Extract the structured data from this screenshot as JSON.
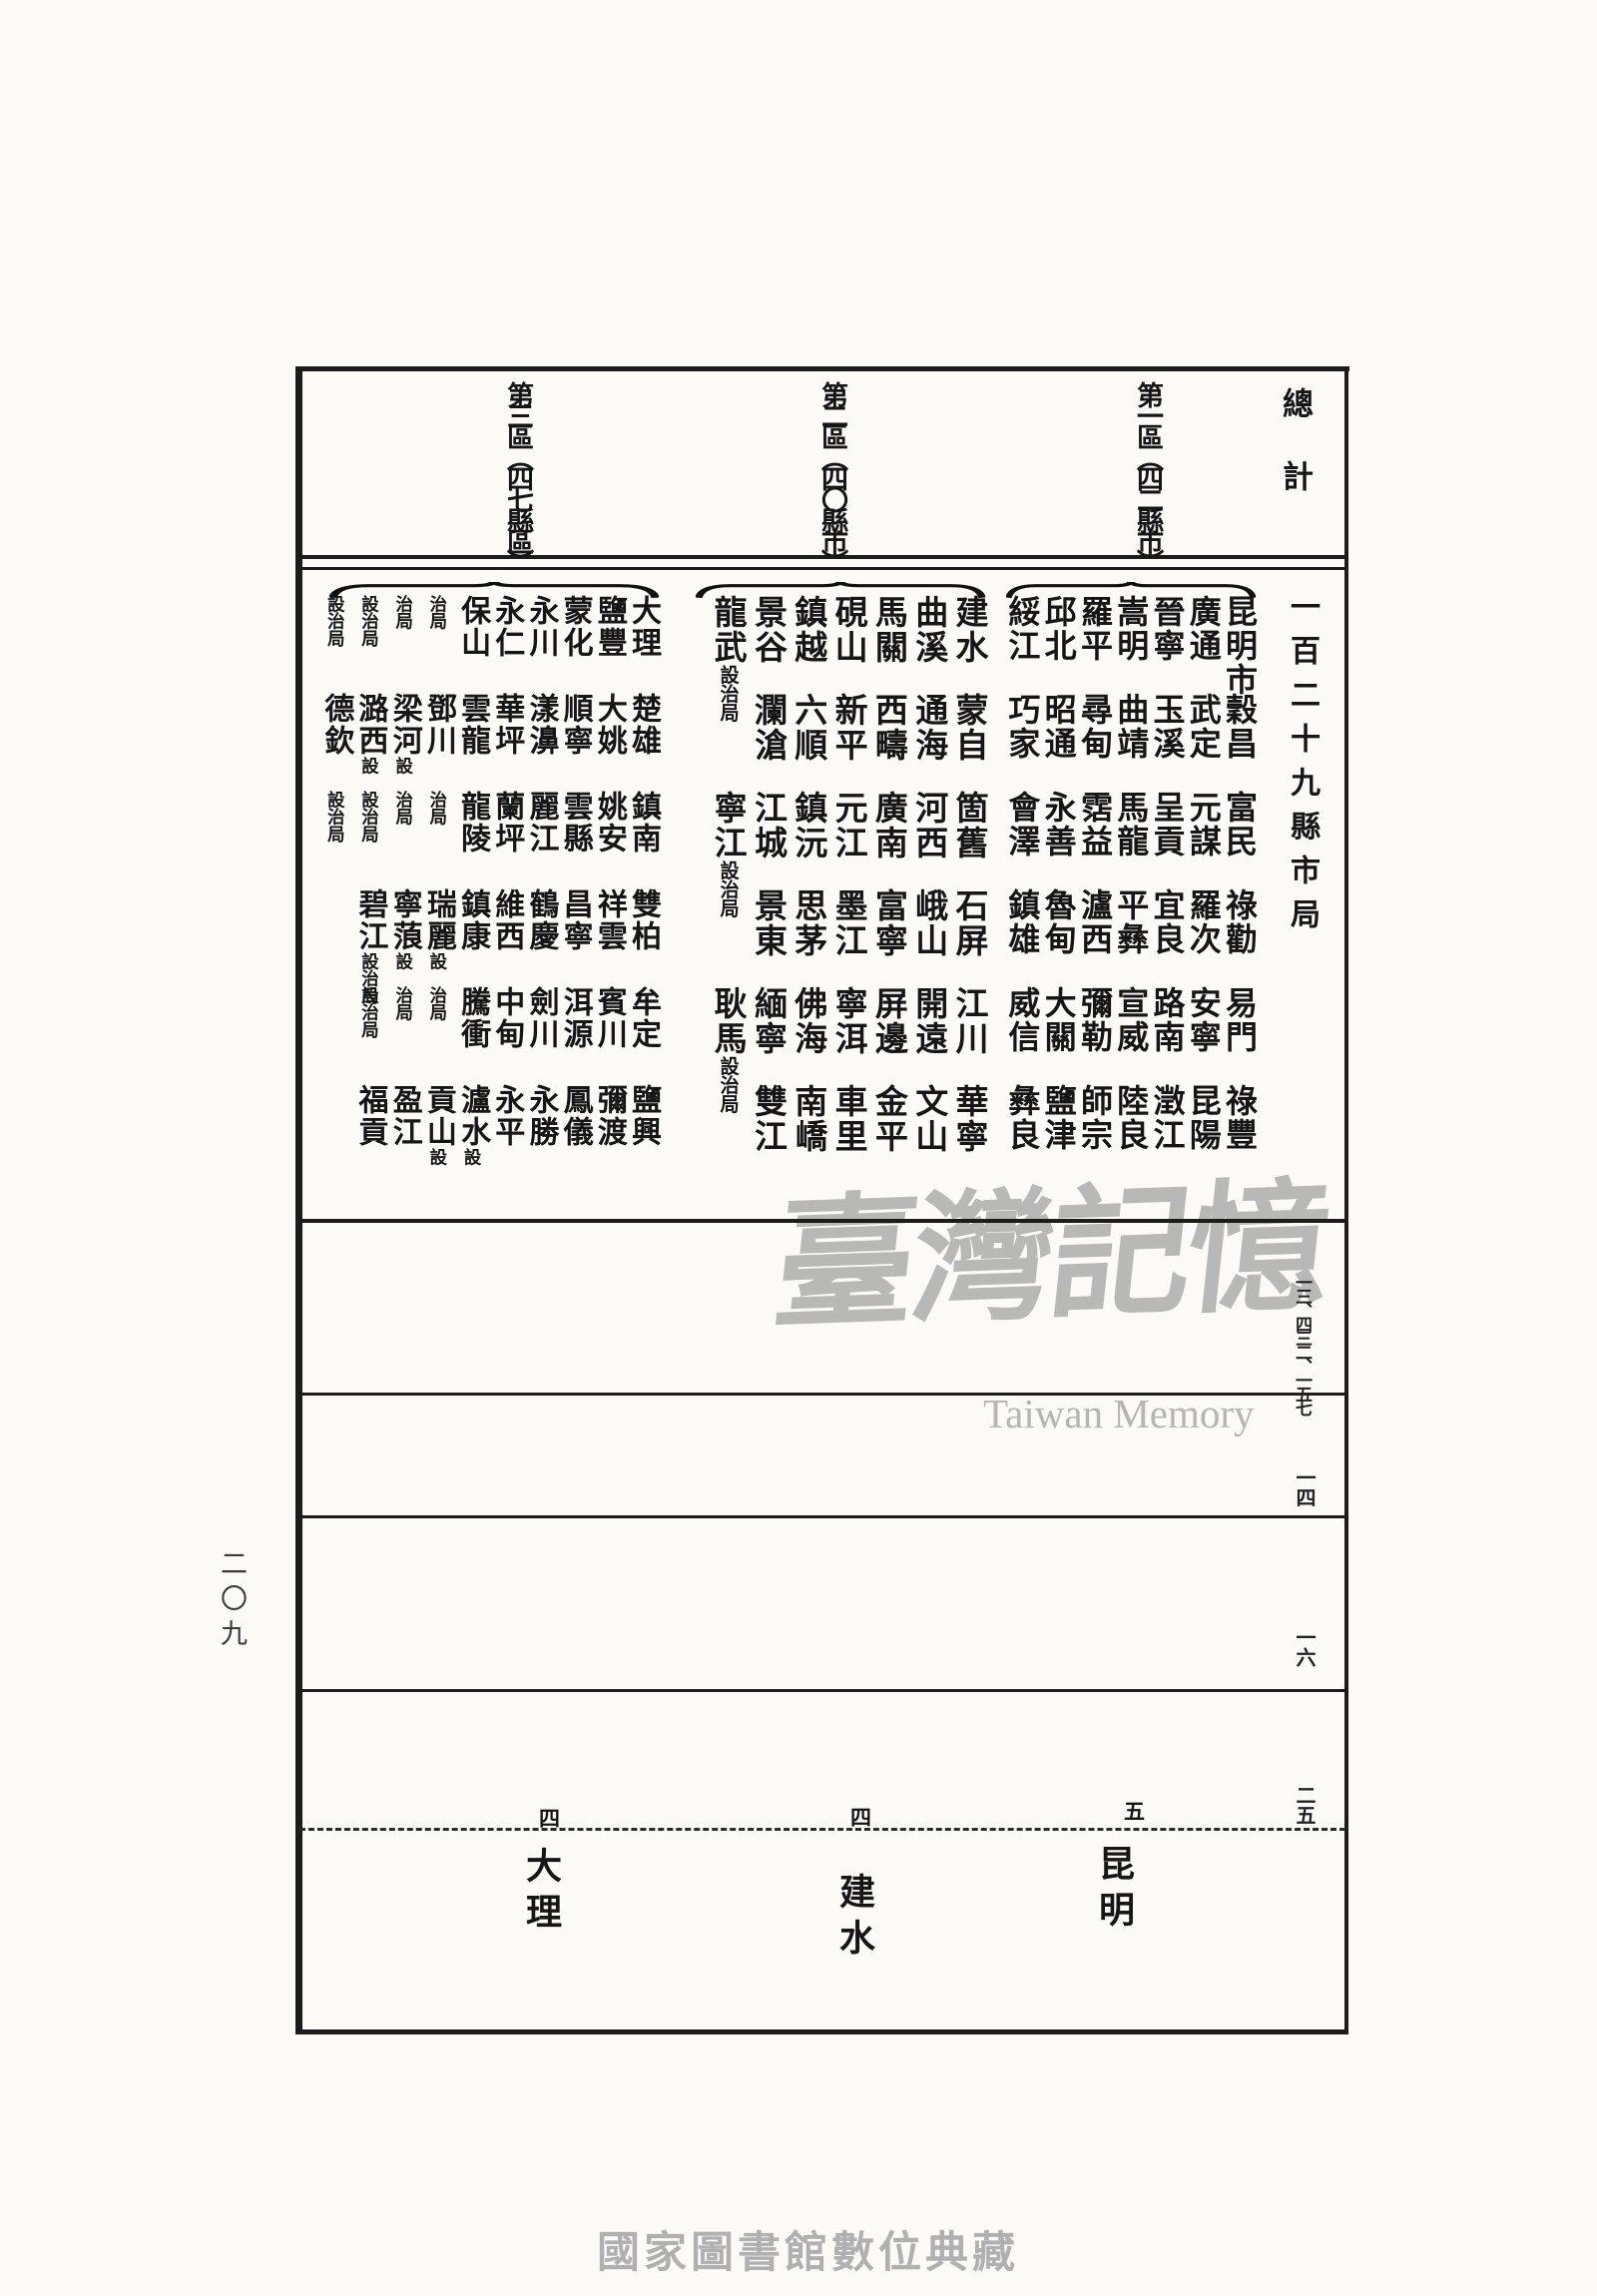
{
  "page": {
    "page_number": "二〇九",
    "caption": "國家圖書館數位典藏"
  },
  "watermark": {
    "cjk": "臺灣記憶",
    "latin": "Taiwan Memory"
  },
  "table": {
    "total_label": "總計",
    "total_value": "一百二十九縣市局",
    "header_regions": [
      "第一區︵四二縣市︶",
      "第二區︵四〇縣市︶",
      "第三區︵四七縣區︶"
    ],
    "margin_numbers": [
      "一三、四三二、一五七",
      "一四",
      "一六",
      "二五"
    ],
    "regions": [
      {
        "label": "第一區",
        "groups": [
          [
            [
              "昆明市",
              ""
            ],
            [
              "廣通",
              ""
            ],
            [
              "晉寧",
              ""
            ],
            [
              "嵩明",
              ""
            ],
            [
              "羅平",
              ""
            ],
            [
              "邱北",
              ""
            ],
            [
              "綏江",
              ""
            ]
          ],
          [
            [
              "穀昌",
              ""
            ],
            [
              "武定",
              ""
            ],
            [
              "玉溪",
              ""
            ],
            [
              "曲靖",
              ""
            ],
            [
              "尋甸",
              ""
            ],
            [
              "昭通",
              ""
            ],
            [
              "巧家",
              ""
            ]
          ],
          [
            [
              "富民",
              ""
            ],
            [
              "元謀",
              ""
            ],
            [
              "呈貢",
              ""
            ],
            [
              "馬龍",
              ""
            ],
            [
              "霑益",
              ""
            ],
            [
              "永善",
              ""
            ],
            [
              "會澤",
              ""
            ]
          ],
          [
            [
              "祿勸",
              ""
            ],
            [
              "羅次",
              ""
            ],
            [
              "宜良",
              ""
            ],
            [
              "平彝",
              ""
            ],
            [
              "瀘西",
              ""
            ],
            [
              "魯甸",
              ""
            ],
            [
              "鎮雄",
              ""
            ]
          ],
          [
            [
              "易門",
              ""
            ],
            [
              "安寧",
              ""
            ],
            [
              "路南",
              ""
            ],
            [
              "宣威",
              ""
            ],
            [
              "彌勒",
              ""
            ],
            [
              "大關",
              ""
            ],
            [
              "威信",
              ""
            ]
          ],
          [
            [
              "祿豐",
              ""
            ],
            [
              "昆陽",
              ""
            ],
            [
              "澂江",
              ""
            ],
            [
              "陸良",
              ""
            ],
            [
              "師宗",
              ""
            ],
            [
              "鹽津",
              ""
            ],
            [
              "彝良",
              ""
            ]
          ]
        ]
      },
      {
        "label": "第二區",
        "groups": [
          [
            [
              "建水",
              ""
            ],
            [
              "曲溪",
              ""
            ],
            [
              "馬關",
              ""
            ],
            [
              "硯山",
              ""
            ],
            [
              "鎮越",
              ""
            ],
            [
              "景谷",
              ""
            ],
            [
              "龍武",
              "設治局"
            ]
          ],
          [
            [
              "蒙自",
              ""
            ],
            [
              "通海",
              ""
            ],
            [
              "西疇",
              ""
            ],
            [
              "新平",
              ""
            ],
            [
              "六順",
              ""
            ],
            [
              "瀾滄",
              ""
            ]
          ],
          [
            [
              "箇舊",
              ""
            ],
            [
              "河西",
              ""
            ],
            [
              "廣南",
              ""
            ],
            [
              "元江",
              ""
            ],
            [
              "鎮沅",
              ""
            ],
            [
              "江城",
              ""
            ],
            [
              "寧江",
              "設治局"
            ]
          ],
          [
            [
              "石屏",
              ""
            ],
            [
              "峨山",
              ""
            ],
            [
              "富寧",
              ""
            ],
            [
              "墨江",
              ""
            ],
            [
              "思茅",
              ""
            ],
            [
              "景東",
              ""
            ]
          ],
          [
            [
              "江川",
              ""
            ],
            [
              "開遠",
              ""
            ],
            [
              "屏邊",
              ""
            ],
            [
              "寧洱",
              ""
            ],
            [
              "佛海",
              ""
            ],
            [
              "緬寧",
              ""
            ],
            [
              "耿馬",
              "設治局"
            ]
          ],
          [
            [
              "華寧",
              ""
            ],
            [
              "文山",
              ""
            ],
            [
              "金平",
              ""
            ],
            [
              "車里",
              ""
            ],
            [
              "南嶠",
              ""
            ],
            [
              "雙江",
              ""
            ]
          ]
        ]
      },
      {
        "label": "第三區",
        "groups": [
          [
            [
              "大理",
              ""
            ],
            [
              "鹽豐",
              ""
            ],
            [
              "蒙化",
              ""
            ],
            [
              "永川",
              ""
            ],
            [
              "永仁",
              ""
            ],
            [
              "保山",
              ""
            ],
            [
              "",
              "治局"
            ],
            [
              "",
              "治局"
            ],
            [
              "",
              "設治局"
            ],
            [
              "",
              "設治局"
            ]
          ],
          [
            [
              "楚雄",
              ""
            ],
            [
              "大姚",
              ""
            ],
            [
              "順寧",
              ""
            ],
            [
              "漾濞",
              ""
            ],
            [
              "華坪",
              ""
            ],
            [
              "雲龍",
              ""
            ],
            [
              "鄧川",
              ""
            ],
            [
              "梁河",
              "設"
            ],
            [
              "潞西",
              "設"
            ],
            [
              "德欽",
              ""
            ]
          ],
          [
            [
              "鎮南",
              ""
            ],
            [
              "姚安",
              ""
            ],
            [
              "雲縣",
              ""
            ],
            [
              "麗江",
              ""
            ],
            [
              "蘭坪",
              ""
            ],
            [
              "龍陵",
              ""
            ],
            [
              "",
              "治局"
            ],
            [
              "",
              "治局"
            ],
            [
              "",
              "設治局"
            ],
            [
              "",
              "設治局"
            ]
          ],
          [
            [
              "雙柏",
              ""
            ],
            [
              "祥雲",
              ""
            ],
            [
              "昌寧",
              ""
            ],
            [
              "鶴慶",
              ""
            ],
            [
              "維西",
              ""
            ],
            [
              "鎮康",
              ""
            ],
            [
              "瑞麗",
              "設"
            ],
            [
              "寧蒗",
              "設"
            ],
            [
              "碧江",
              "設治局"
            ]
          ],
          [
            [
              "牟定",
              ""
            ],
            [
              "賓川",
              ""
            ],
            [
              "洱源",
              ""
            ],
            [
              "劍川",
              ""
            ],
            [
              "中甸",
              ""
            ],
            [
              "騰衝",
              ""
            ],
            [
              "",
              "治局"
            ],
            [
              "",
              "治局"
            ],
            [
              "",
              "設治局"
            ]
          ],
          [
            [
              "鹽興",
              ""
            ],
            [
              "彌渡",
              ""
            ],
            [
              "鳳儀",
              ""
            ],
            [
              "永勝",
              ""
            ],
            [
              "永平",
              ""
            ],
            [
              "瀘水",
              "設"
            ],
            [
              "貢山",
              "設"
            ],
            [
              "盈江",
              ""
            ],
            [
              "福貢",
              ""
            ]
          ]
        ]
      }
    ],
    "bottom_row": {
      "entries": [
        {
          "marker": "五",
          "name": "昆明"
        },
        {
          "marker": "四",
          "name": "建水"
        },
        {
          "marker": "四",
          "name": "大理"
        }
      ]
    }
  }
}
